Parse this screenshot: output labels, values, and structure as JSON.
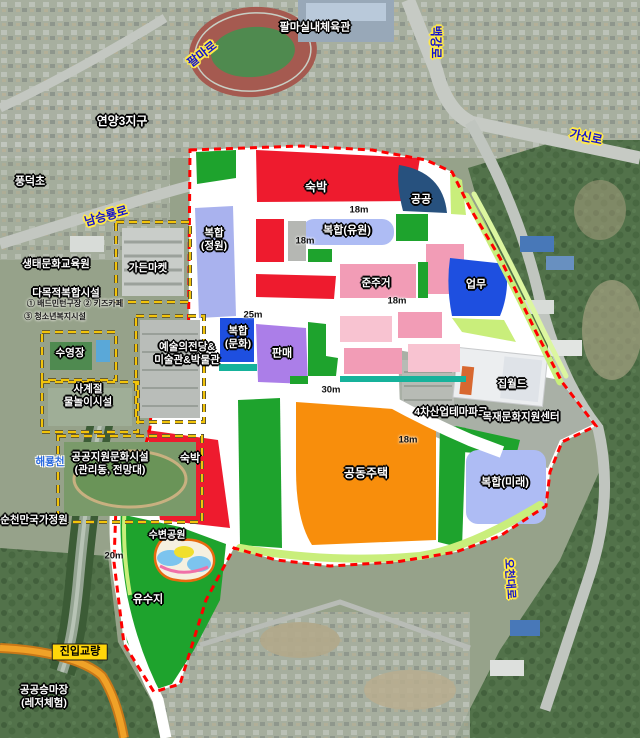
{
  "roads": {
    "palma_ro": "팔마로",
    "baekgang_ro": "백강로",
    "namseungryong_ro": "남승룡로",
    "gasin_ro": "가신로",
    "ocheon_daero": "오천대로"
  },
  "places": {
    "gym": "팔마실내체육관",
    "yeonyang": "연양3지구",
    "pungdeok": "풍덕초",
    "eco_center": "생태문화교육원",
    "garden_market": "가든마켓",
    "multi_facility": "다목적복합시설",
    "multi_items_1": "① 배드민턴구장  ② 키즈카페",
    "multi_items_2": "③ 청소년복지시설",
    "arts_hall_1": "예술의전당&",
    "arts_hall_2": "미술관&박물관",
    "pool": "수영장",
    "seasons_1": "사계절",
    "seasons_2": "물놀이시설",
    "public_support_1": "공공지원문화시설",
    "public_support_2": "(관리동, 전망대)",
    "haeryong_stream": "해룡천",
    "suncheon_garden": "순천만국가정원",
    "jip_world": "집월드",
    "theme_park": "4차산업테마파크",
    "wood_center": "목재문화지원센터",
    "entry_bridge": "진입교량",
    "horse_1": "공공승마장",
    "horse_2": "(레저체험)"
  },
  "zones": {
    "lodging_top": "숙박",
    "public": "공공",
    "mixed_amusement": "복합(유원)",
    "mixed_garden_1": "복합",
    "mixed_garden_2": "(정원)",
    "semi_residential": "준주거",
    "business": "업무",
    "mixed_culture_1": "복합",
    "mixed_culture_2": "(문화)",
    "retail": "판매",
    "lodging_bottom": "숙박",
    "housing": "공동주택",
    "mixed_future": "복합(미래)",
    "waterfront_park": "수변공원",
    "detention_pond": "유수지"
  },
  "dimensions": {
    "d1": "18m",
    "d2": "18m",
    "d3": "18m",
    "d4": "25m",
    "d5": "30m",
    "d6": "18m",
    "d7": "20m"
  },
  "zone_colors": {
    "red": "#ee1b2e",
    "green": "#1ea32d",
    "periwinkle": "#a9b2ee",
    "periwinkle2": "#aebcf4",
    "navy": "#27517e",
    "blue": "#1e4fe0",
    "pink": "#f29cb6",
    "pink_light": "#f8c3d1",
    "purple": "#ab7ee8",
    "orange": "#f88e0c",
    "gray": "#b5b7b3",
    "lime": "#c9ee7b",
    "pale_green": "#dcf6a0",
    "teal": "#16b29b",
    "boundary_red": "#ff0000",
    "facility_dash_yellow": "#f2c40a",
    "road_white": "#ffffff",
    "pond_blue": "#7cc4ee",
    "pond_yellow": "#f0df2e",
    "pond_ring": "#e86a10",
    "pond_pink": "#f070a8"
  }
}
